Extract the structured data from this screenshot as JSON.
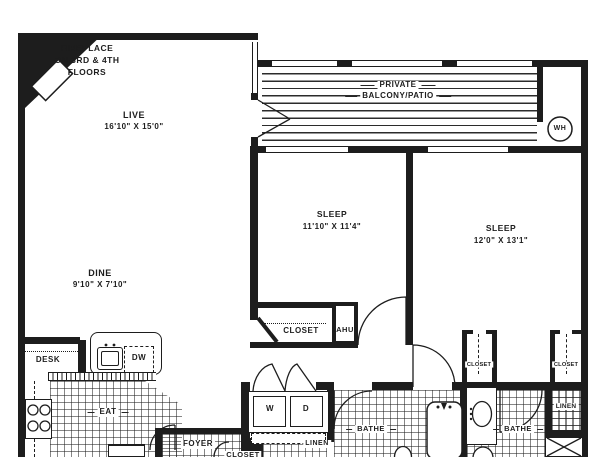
{
  "floorplan": {
    "colors": {
      "line": "#1d1d1d",
      "background": "#ffffff"
    },
    "note": {
      "line1": "FIREPLACE",
      "line2": "ON 3RD & 4TH",
      "line3": "FLOORS"
    },
    "rooms": {
      "live": {
        "name": "LIVE",
        "dims": "16'10\" X 15'0\""
      },
      "dine": {
        "name": "DINE",
        "dims": "9'10\" X 7'10\""
      },
      "sleep_1": {
        "name": "SLEEP",
        "dims": "11'10\" X 11'4\""
      },
      "sleep_2": {
        "name": "SLEEP",
        "dims": "12'0\" X 13'1\""
      },
      "balcony": {
        "name_line1": "PRIVATE",
        "name_line2": "BALCONY/PATIO"
      },
      "eat": "EAT",
      "foyer": "FOYER",
      "bathe": "BATHE"
    },
    "labels": {
      "closet": "CLOSET",
      "linen": "LINEN",
      "ahu": "AHU",
      "desk": "DESK",
      "dishwasher": "DW",
      "washer": "W",
      "dryer": "D",
      "water_heater": "WH"
    }
  }
}
